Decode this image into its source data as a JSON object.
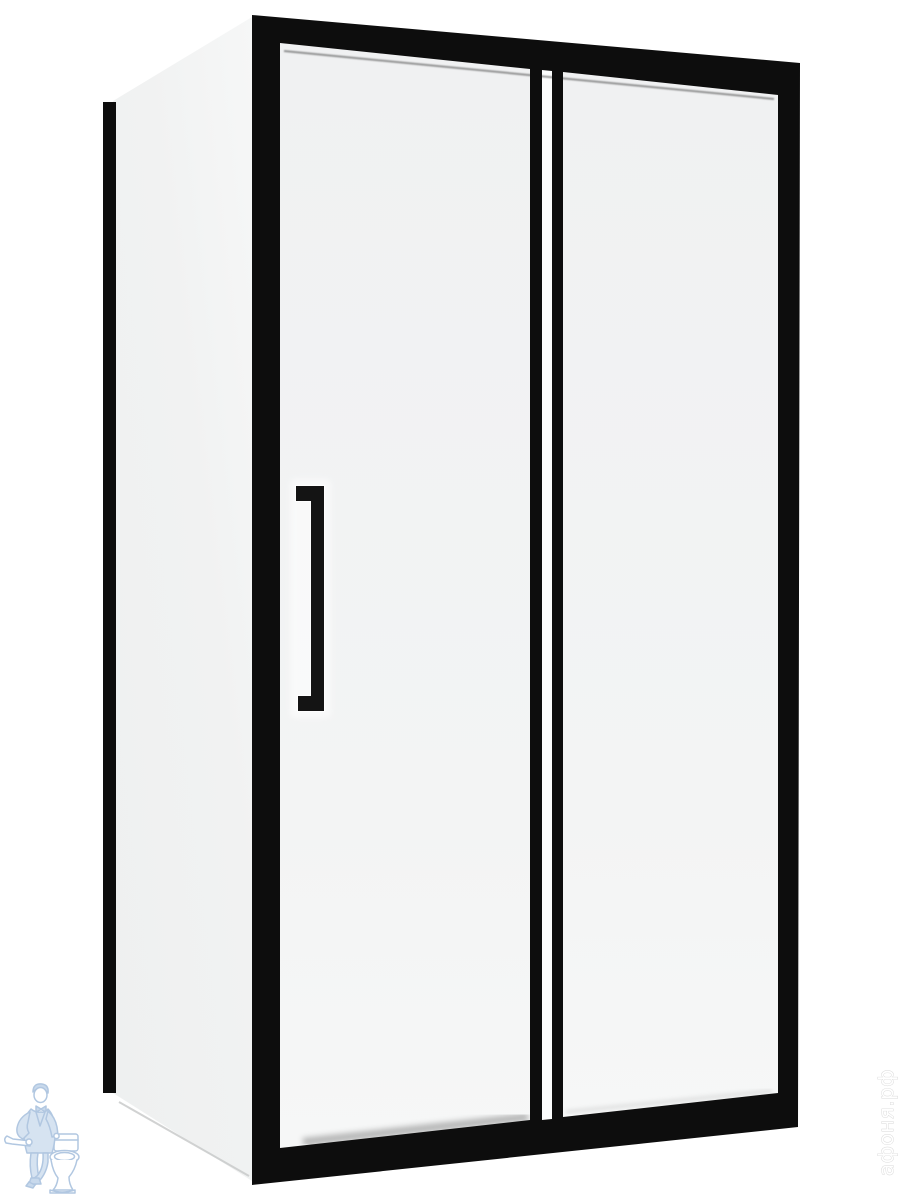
{
  "image": {
    "kind": "product-photo",
    "subject": "rectangular shower enclosure with black matte aluminium profile, corner entry, sliding glass door with vertical handle"
  },
  "watermark": {
    "store_text": "афоня.рф",
    "text_color": "#ffffff",
    "logo_color": "#a9c2de"
  },
  "colors": {
    "background": "#ffffff",
    "frame": "#0d0d0d",
    "handle": "#141414",
    "front_glass": "#f3f4f4",
    "side_glass": "#f0f1f1",
    "gap_glass": "#fbfcfc"
  }
}
